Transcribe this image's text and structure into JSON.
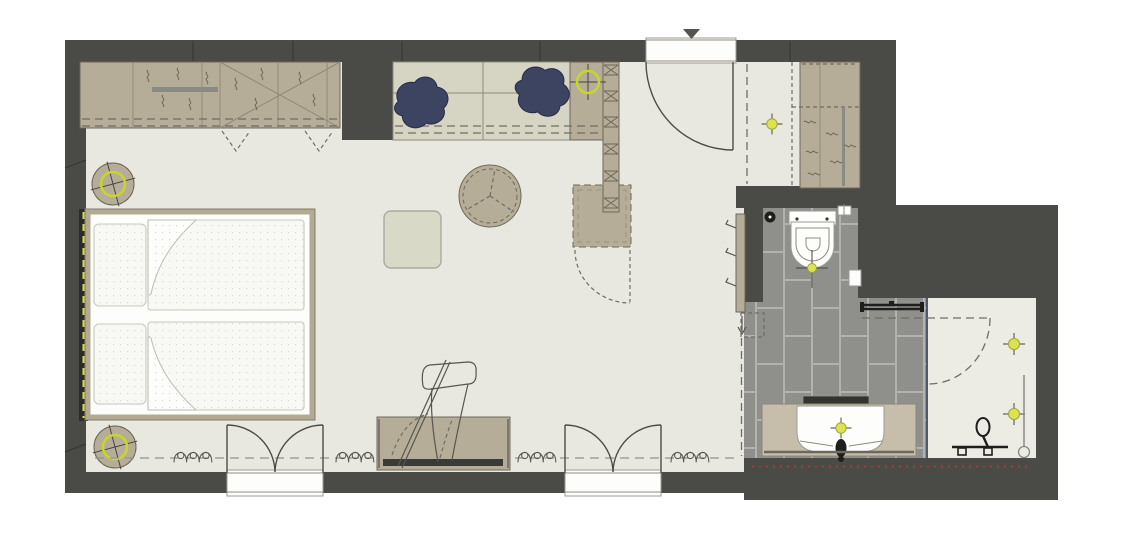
{
  "document": {
    "type": "architectural-floor-plan",
    "view": "top-down-plan",
    "scale_text": ""
  },
  "colors": {
    "wall": "#4a4a47",
    "floor": "#e9e8e0",
    "tan": "#b5ad97",
    "tanline": "#6d675a",
    "desk": "#d6d4c3",
    "sage": "#d9d9c8",
    "navy": "#3d4462",
    "tile": "#8f8f8b",
    "grout": "#b3b2ae",
    "showerfloor": "#edece4",
    "accent": "#c9d42f",
    "accentfill": "#dde34f",
    "bedframe": "#b2aa93",
    "headboard": "#2c2c29",
    "paper": "#fdfdfc",
    "dash": "#6f6d64",
    "ink": "#4e4c46",
    "red": "#a83a2f"
  },
  "legend": {
    "bedroom_items": [
      "wardrobe-with-hanging-rails",
      "double-bed",
      "pillows-x2",
      "duvets-x2",
      "headboard-panel-with-led-strip",
      "round-bedside-table-x2",
      "desk-with-drawers",
      "desk-chair-x2",
      "shelf-column",
      "minibar-cabinet",
      "round-coffee-table",
      "square-pouf",
      "luggage-bench-with-folding-rack",
      "french-balcony-door-x2",
      "curtain-symbol-x4",
      "coat-hook-panel"
    ],
    "entry_items": [
      "entrance-door",
      "entry-ceiling-light",
      "entry-closet-with-rail"
    ],
    "bathroom_items": [
      "wall-hung-toilet",
      "toilet-paper-holder",
      "floor-drain",
      "flush-panel",
      "towel-rail",
      "mirror",
      "vanity-counter-with-basin",
      "faucet",
      "glass-shower-screen",
      "shower-door-swing",
      "hand-shower-on-rail",
      "grab-bar",
      "shower-drain"
    ],
    "light_symbols": [
      "desk-ceiling-light",
      "entry-ceiling-light",
      "toilet-light",
      "vanity-light",
      "shower-light-x2",
      "bedside-ring-light-x2"
    ]
  }
}
